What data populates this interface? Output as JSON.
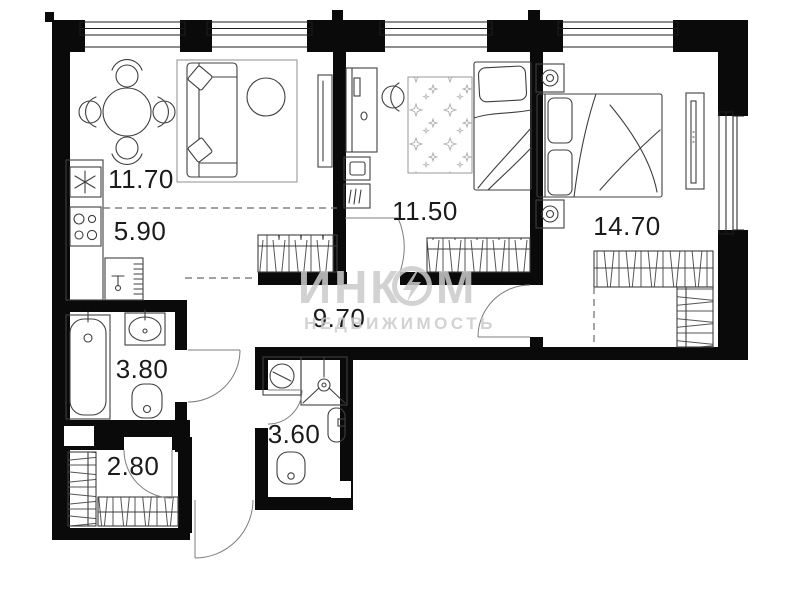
{
  "plan": {
    "title": "apartment-floor-plan",
    "rooms": {
      "living": {
        "area": "11.70"
      },
      "kitchen": {
        "area": "5.90"
      },
      "bedroom1": {
        "area": "11.50"
      },
      "bedroom2": {
        "area": "14.70"
      },
      "hallway": {
        "area": "9.70"
      },
      "bathroom": {
        "area": "3.80"
      },
      "wc": {
        "area": "3.60"
      },
      "storage": {
        "area": "2.80"
      }
    },
    "watermark": {
      "brand": "ИНК",
      "brand_end": "М",
      "tagline": "НЕДВИЖИМОСТЬ"
    },
    "colors": {
      "wall": "#0a0a0a",
      "furniture_line": "#3f3f3f",
      "watermark": "#cbcbcb",
      "background": "#ffffff"
    }
  }
}
